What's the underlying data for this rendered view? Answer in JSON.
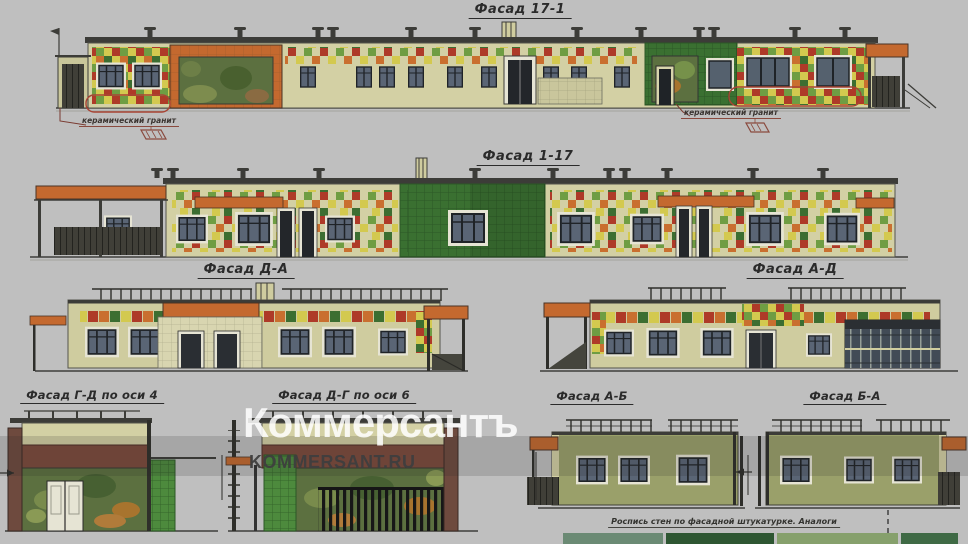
{
  "page": {
    "background": "#bfbfbf"
  },
  "titles": [
    {
      "label": "Фасад 17-1"
    },
    {
      "label": "Фасад 1-17"
    },
    {
      "label": "Фасад Д-А"
    },
    {
      "label": "Фасад А-Д"
    },
    {
      "label": "Фасад Г-Д по оси 4"
    },
    {
      "label": "Фасад Д-Г по оси 6"
    },
    {
      "label": "Фасад А-Б"
    },
    {
      "label": "Фасад Б-А"
    }
  ],
  "annotations": {
    "ceramic_left": "керамический гранит",
    "ceramic_right": "керамический гранит",
    "bottom_note": "Роспись стен по фасадной штукатурке. Аналоги"
  },
  "watermark": {
    "brand": "Коммерсантъ",
    "site": "KOMMERSANT.RU"
  },
  "colors": {
    "wall_beige": "#d3d0a4",
    "wall_olive": "#9aa06a",
    "canopy_orange": "#c4692f",
    "tile_green_dark": "#3a7031",
    "accent_red": "#a84434",
    "maroon_band": "#7c4a3c"
  }
}
